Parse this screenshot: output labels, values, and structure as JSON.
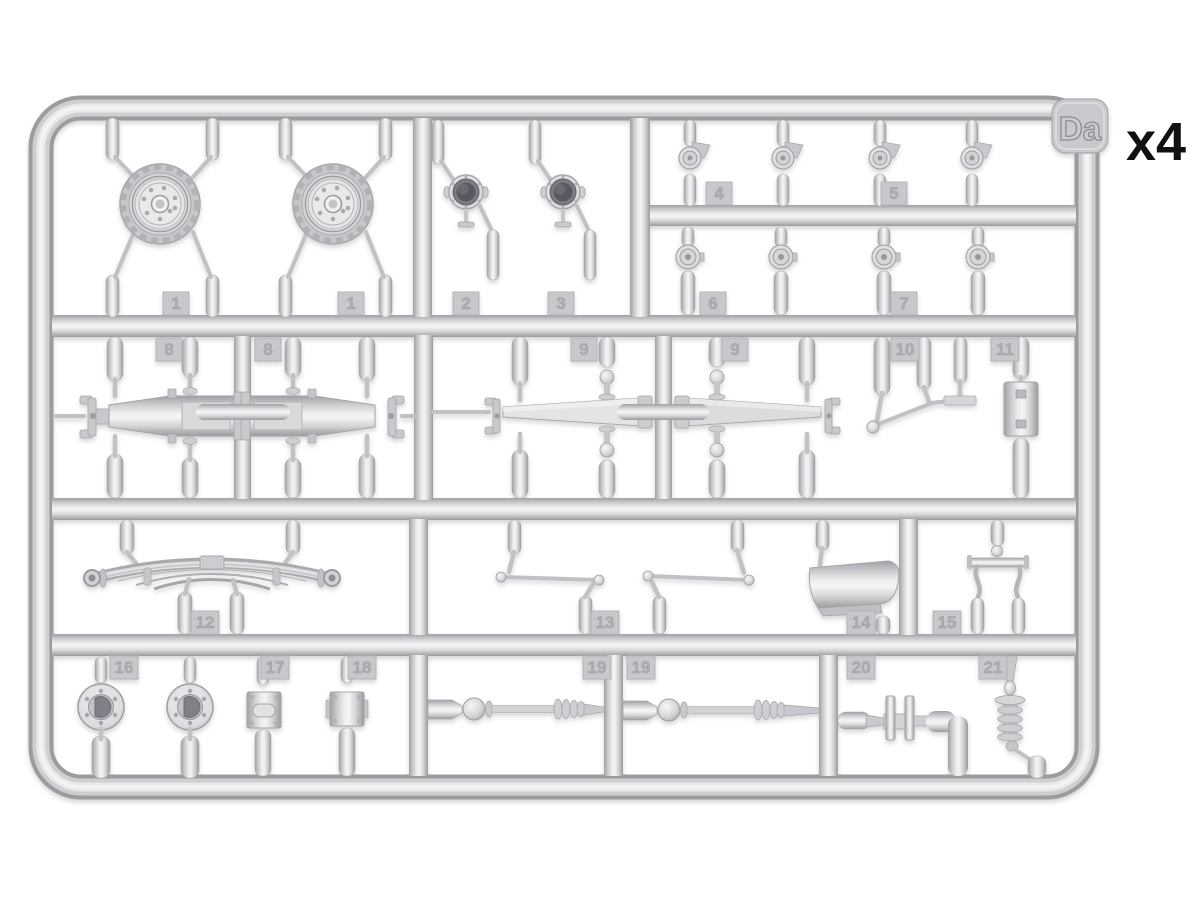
{
  "page": {
    "background": "#ffffff",
    "quantity_label": "x4"
  },
  "sprue": {
    "code": "Da",
    "material_colors": {
      "plastic_light": "#f3f3f5",
      "plastic_mid": "#d6d6d9",
      "plastic_dark": "#9d9da2",
      "part_recess_dark": "#595961"
    },
    "part_tags": [
      {
        "number": "1"
      },
      {
        "number": "1"
      },
      {
        "number": "2"
      },
      {
        "number": "3"
      },
      {
        "number": "4"
      },
      {
        "number": "5"
      },
      {
        "number": "6"
      },
      {
        "number": "7"
      },
      {
        "number": "8"
      },
      {
        "number": "8"
      },
      {
        "number": "9"
      },
      {
        "number": "9"
      },
      {
        "number": "10"
      },
      {
        "number": "11"
      },
      {
        "number": "12"
      },
      {
        "number": "13"
      },
      {
        "number": "14"
      },
      {
        "number": "15"
      },
      {
        "number": "16"
      },
      {
        "number": "17"
      },
      {
        "number": "18"
      },
      {
        "number": "19"
      },
      {
        "number": "19"
      },
      {
        "number": "20"
      },
      {
        "number": "21"
      }
    ]
  }
}
